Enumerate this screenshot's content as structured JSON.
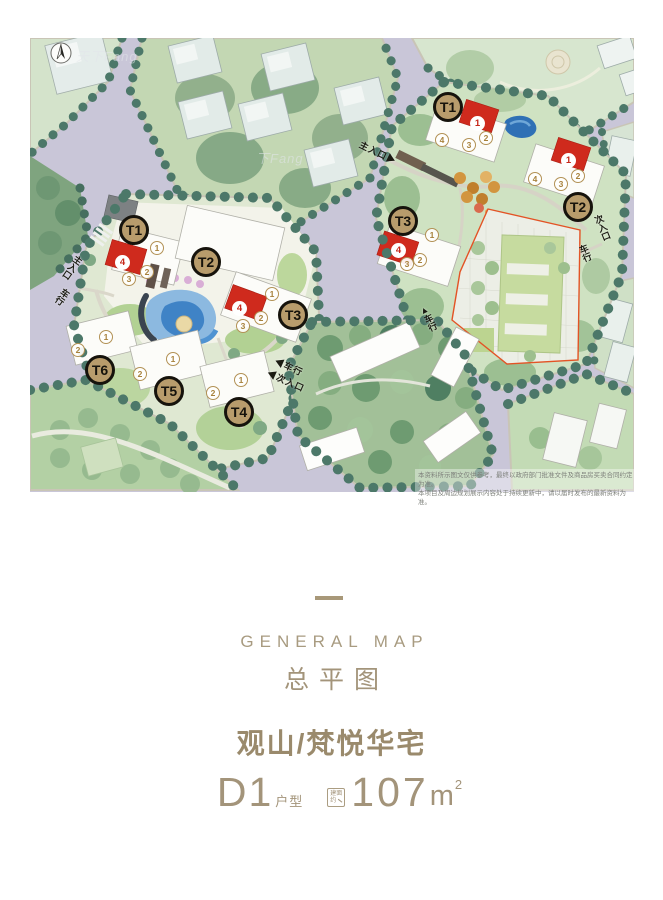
{
  "map": {
    "compass_label": "N",
    "watermarks": [
      "天下Fang",
      "下Fang"
    ],
    "left_block": {
      "towers": [
        "T1",
        "T2",
        "T3",
        "T4",
        "T5",
        "T6"
      ],
      "units_t1": [
        "1",
        "2",
        "3",
        "4"
      ],
      "units_t3": [
        "1",
        "2",
        "3",
        "4"
      ],
      "units_t6": [
        "1",
        "2"
      ],
      "units_t5": [
        "1",
        "2"
      ],
      "units_t4": [
        "1",
        "2"
      ]
    },
    "right_block": {
      "towers": [
        "T1",
        "T2",
        "T3"
      ],
      "units_t1": [
        "1",
        "2",
        "3",
        "4"
      ],
      "units_t2": [
        "1",
        "2",
        "3",
        "4"
      ],
      "units_t3": [
        "1",
        "2",
        "3",
        "4"
      ]
    },
    "entrances": {
      "left_main": "主入口",
      "left_vehicle": "车行",
      "left_east_vehicle": "◀车行",
      "left_east_sub": "◀次入口",
      "right_main": "主入口▶",
      "right_sub": "次入口",
      "right_vehicle": "车行",
      "school_vehicle": "▲车行"
    },
    "disclaimer_line1": "本资料所示图文仅供参考，最终以政府部门批准文件及商品房买卖合同约定为准。",
    "disclaimer_line2": "本项目及周边规划展示内容处于持续更新中，请以届时发布的最新资料为准。"
  },
  "footer": {
    "subtitle_en": "GENERAL MAP",
    "title_cn": "总平图",
    "project_name": "观山/梵悦华宅",
    "unit_code": "D1",
    "unit_suffix": "户型",
    "badge_line1": "建面",
    "badge_line2": "约",
    "area_value": "107",
    "area_unit": "m",
    "area_sup": "2"
  },
  "colors": {
    "accent_tan": "#a3947a",
    "marker_gold": "#b89c6c",
    "highlight_red": "#cf2a1d",
    "road_lavender": "#c9c6d8",
    "tree_green": "#4c7869"
  }
}
